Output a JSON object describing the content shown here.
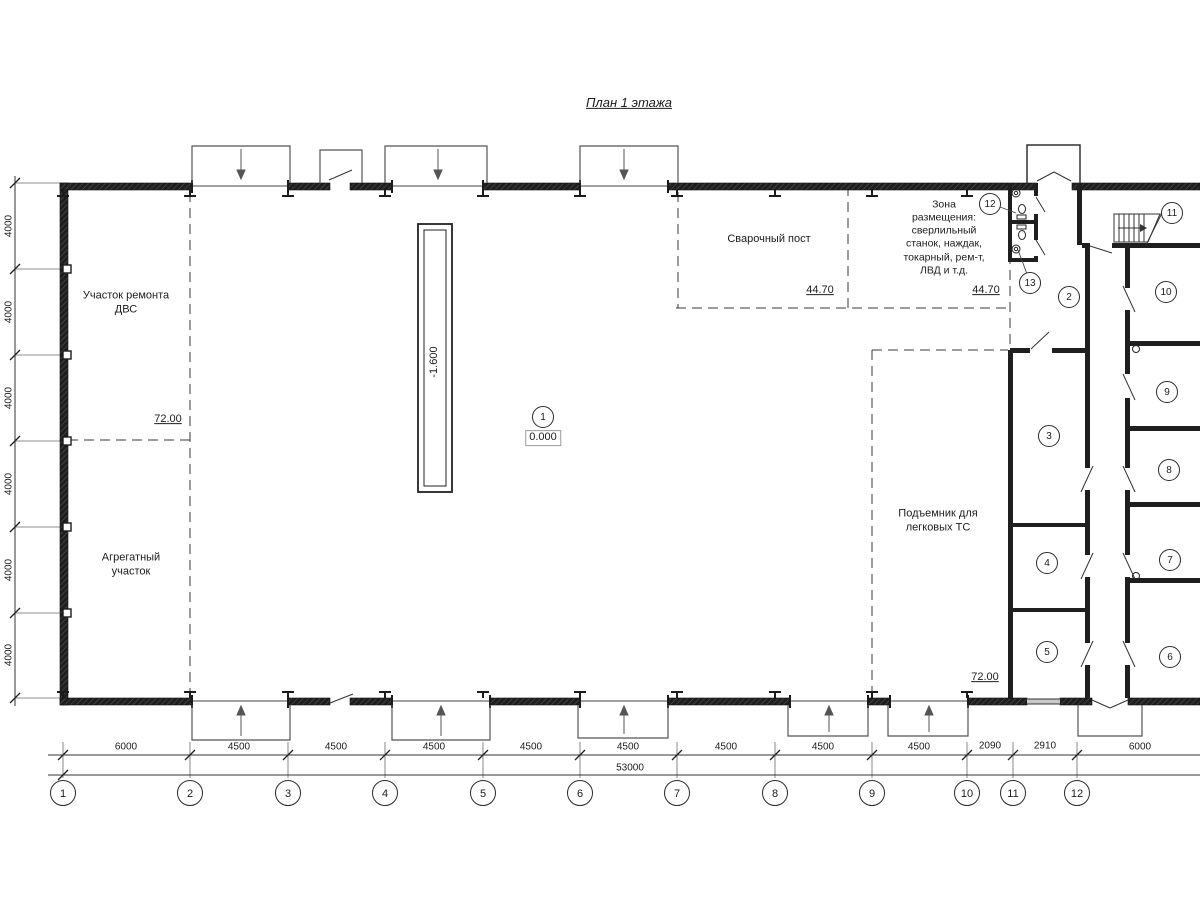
{
  "title": "План 1 этажа",
  "zones": {
    "engine_repair": "Участок ремонта\nДВС",
    "aggregate": "Агрегатный\nучасток",
    "welding": "Сварочный пост",
    "placement": "Зона\nразмещения:\nсверлильный\nстанок, наждак,\nтокарный, рем-т,\nЛВД и т.д.",
    "car_lift": "Подъемник для\nлегковых ТС"
  },
  "elevations": {
    "aggregate_zone": "72.00",
    "car_lift_zone": "72.00",
    "welding_zone": "44.70",
    "placement_zone": "44.70",
    "main_floor": "0.000",
    "pit": "-1.600"
  },
  "rooms": [
    "1",
    "2",
    "3",
    "4",
    "5",
    "6",
    "7",
    "8",
    "9",
    "10",
    "11",
    "12",
    "13"
  ],
  "axes": [
    "1",
    "2",
    "3",
    "4",
    "5",
    "6",
    "7",
    "8",
    "9",
    "10",
    "11",
    "12"
  ],
  "dims_bottom": [
    "6000",
    "4500",
    "4500",
    "4500",
    "4500",
    "4500",
    "4500",
    "4500",
    "4500",
    "2090",
    "2910",
    "6000"
  ],
  "dim_total": "53000",
  "dims_left": [
    "4000",
    "4000",
    "4000",
    "4000",
    "4000",
    "4000"
  ]
}
